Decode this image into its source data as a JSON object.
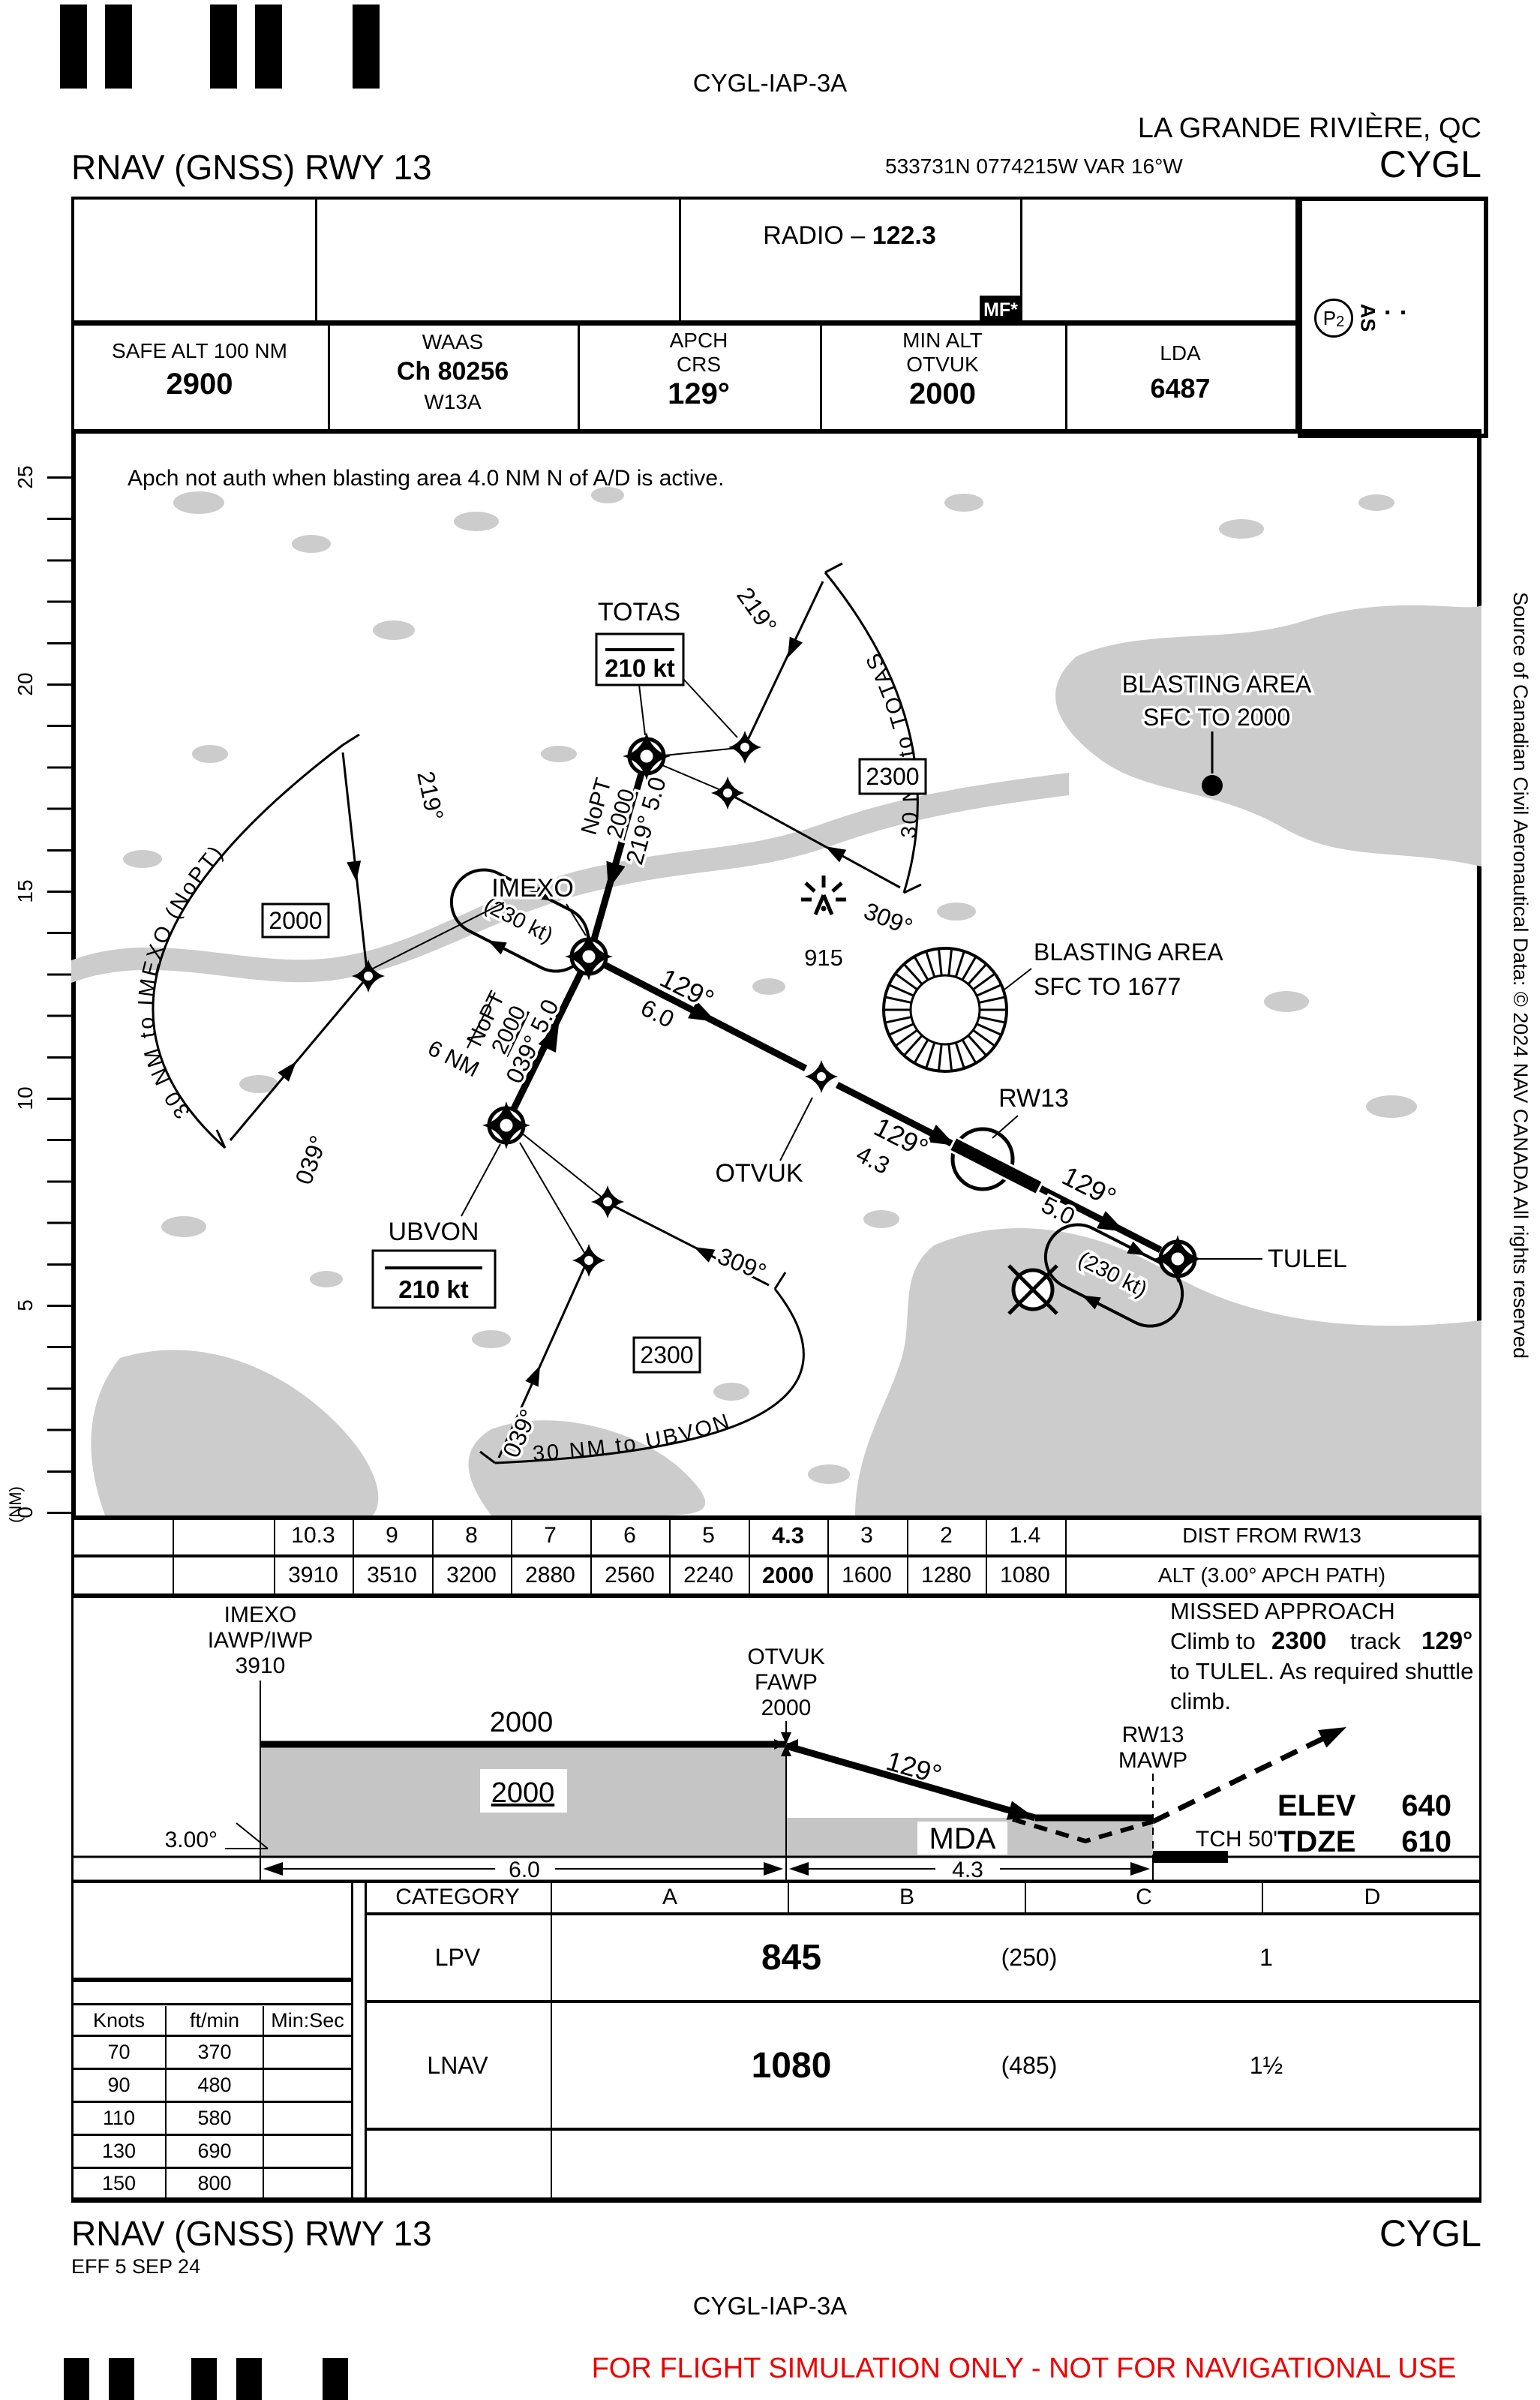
{
  "colors": {
    "warning_red": "#ef0000",
    "terrain_gray": "#cccccc",
    "profile_gray": "#c5c5c5",
    "ink": "#000000"
  },
  "header": {
    "chart_code": "CYGL-IAP-3A",
    "city": "LA GRANDE RIVIÈRE, QC",
    "title": "RNAV (GNSS) RWY 13",
    "coords": "533731N  0774215W  VAR 16°W",
    "airport": "CYGL"
  },
  "comm": {
    "radio_label": "RADIO – ",
    "radio_freq": "122.3",
    "mf": "MF*",
    "p_symbol": "P",
    "p_sub": "2",
    "as_label": "AS",
    "dots": "· ·"
  },
  "info": {
    "safe_alt_label": "SAFE ALT 100 NM",
    "safe_alt": "2900",
    "waas_label": "WAAS",
    "waas_ch": "Ch 80256",
    "waas_id": "W13A",
    "apch_label": "APCH",
    "crs_label": "CRS",
    "crs": "129°",
    "minalt_label": "MIN ALT",
    "minalt_fix": "OTVUK",
    "minalt": "2000",
    "lda_label": "LDA",
    "lda": "6487"
  },
  "plan": {
    "note": "Apch not auth when blasting area 4.0 NM N of A/D is active.",
    "scale": [
      "25",
      "20",
      "15",
      "10",
      "5",
      "0"
    ],
    "scale_unit": "(NM)",
    "totas": "TOTAS",
    "totas_speed": "210 kt",
    "imexo": "IMEXO",
    "ubvon": "UBVON",
    "ubvon_speed": "210 kt",
    "otvuk": "OTVUK",
    "rw13": "RW13",
    "tulel": "TULEL",
    "arc_totas": "30  NM  to  TOTAS",
    "arc_imexo": "30  NM  to  IMEXO  (NoPT)",
    "arc_ubvon": "30  NM  to  UBVON",
    "arc_totas_alt": "2300",
    "arc_imexo_alt": "2000",
    "arc_ubvon_alt": "2300",
    "brg219": "219°",
    "brg309": "309°",
    "brg039": "039°",
    "t1_nopt": "NoPT",
    "t1_alt": "2000",
    "t1_brg_dist": "219° 5.0",
    "t2_nopt": "NoPT",
    "t2_alt": "2000",
    "t2_brg_dist": "039° 5.0",
    "f1_brg": "129°",
    "f1_dist": "6.0",
    "f2_brg": "129°",
    "f2_dist": "4.3",
    "f3_brg": "129°",
    "f3_dist": "5.0",
    "hold_speed": "(230 kt)",
    "hold_leg": "6 NM",
    "tower_elev": "915",
    "blast_n_1": "BLASTING AREA",
    "blast_n_2": "SFC TO 2000",
    "blast_s_1": "BLASTING AREA",
    "blast_s_2": "SFC TO 1677",
    "source": "Source of Canadian Civil Aeronautical Data: © 2024 NAV CANADA All rights reserved"
  },
  "dist_table": {
    "d": [
      "10.3",
      "9",
      "8",
      "7",
      "6",
      "5",
      "4.3",
      "3",
      "2",
      "1.4"
    ],
    "dist_label": "DIST FROM RW13",
    "a": [
      "3910",
      "3510",
      "3200",
      "2880",
      "2560",
      "2240",
      "2000",
      "1600",
      "1280",
      "1080"
    ],
    "alt_label": "ALT (3.00° APCH PATH)"
  },
  "profile": {
    "imexo_fix": "IMEXO",
    "imexo_role": "IAWP/IWP",
    "imexo_alt": "3910",
    "seg_alt": "2000",
    "seg_alt_box": "2000",
    "otvuk_fix": "OTVUK",
    "otvuk_role": "FAWP",
    "otvuk_alt": "2000",
    "angle": "3.00°",
    "dim1": "6.0",
    "dim2": "4.3",
    "final_brg": "129°",
    "mda": "MDA",
    "mawp_fix": "RW13",
    "mawp_role": "MAWP",
    "tch": "TCH 50'",
    "elev_label": "ELEV",
    "elev": "640",
    "tdze_label": "TDZE",
    "tdze": "610",
    "ma_title": "MISSED APPROACH",
    "ma_l2a": "Climb to",
    "ma_l2b": "2300",
    "ma_l2c": "track",
    "ma_l2d": "129°",
    "ma_l3": "to TULEL. As required shuttle",
    "ma_l4": "climb."
  },
  "minima": {
    "category_label": "CATEGORY",
    "cats": [
      "A",
      "B",
      "C",
      "D"
    ],
    "lpv_label": "LPV",
    "lpv_da": "845",
    "lpv_vis_m": "(250)",
    "lpv_vis": "1",
    "lnav_label": "LNAV",
    "lnav_da": "1080",
    "lnav_vis_m": "(485)",
    "lnav_vis": "1½"
  },
  "rate": {
    "headers": [
      "Knots",
      "ft/min",
      "Min:Sec"
    ],
    "rows": [
      [
        "70",
        "370"
      ],
      [
        "90",
        "480"
      ],
      [
        "110",
        "580"
      ],
      [
        "130",
        "690"
      ],
      [
        "150",
        "800"
      ]
    ]
  },
  "footer": {
    "title": "RNAV (GNSS) RWY 13",
    "airport": "CYGL",
    "eff": "EFF 5 SEP 24",
    "chart_code": "CYGL-IAP-3A",
    "warning": "FOR FLIGHT SIMULATION ONLY - NOT FOR NAVIGATIONAL USE"
  }
}
